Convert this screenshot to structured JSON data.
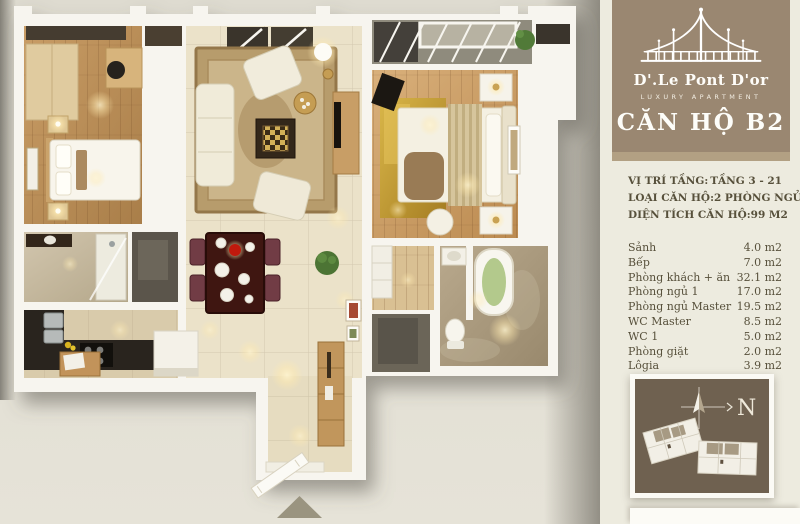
{
  "sidebar": {
    "logo": {
      "name": "D'.Le Pont D'or",
      "subtitle": "LUXURY APARTMENT"
    },
    "title": "CĂN HỘ B2",
    "info": [
      {
        "label": "VỊ TRÍ TẦNG:",
        "value": "TẦNG  3 - 21"
      },
      {
        "label": "LOẠI CĂN HỘ:",
        "value": "2 PHÒNG NGỦ"
      },
      {
        "label": "DIỆN TÍCH CĂN HỘ:",
        "value": "99 M2"
      }
    ],
    "rooms": [
      {
        "name": "Sảnh",
        "area": "4.0 m2"
      },
      {
        "name": "Bếp",
        "area": "7.0 m2"
      },
      {
        "name": "Phòng khách + ăn",
        "area": "32.1 m2"
      },
      {
        "name": "Phòng ngủ 1",
        "area": "17.0 m2"
      },
      {
        "name": "Phòng ngủ Master",
        "area": "19.5 m2"
      },
      {
        "name": "WC Master",
        "area": "8.5 m2"
      },
      {
        "name": "WC 1",
        "area": "5.0 m2"
      },
      {
        "name": "Phòng giặt",
        "area": "2.0 m2"
      },
      {
        "name": "Lôgia",
        "area": "3.9 m2"
      }
    ],
    "compass_label": "N"
  },
  "palette": {
    "sidebar_brown": "#9a8771",
    "sidebar_tan_strip": "#b2a083",
    "sidebar_cream": "#edebdf",
    "sidebar_text": "#57503b",
    "siteplan_box": "#6f6150",
    "page_background": "#e2dfd4",
    "wall_white": "#f7f5ef",
    "wood_floor": "#c99d66",
    "gold_rug": "#d9b649",
    "dining_table": "#3f1611",
    "entrance_arrow": "#9a9480"
  }
}
